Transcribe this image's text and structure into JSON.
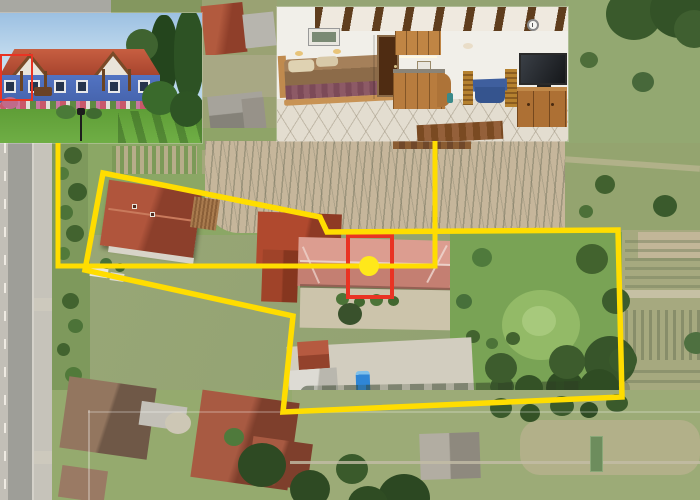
{
  "canvas": {
    "width": 700,
    "height": 500
  },
  "colors": {
    "annotation_yellow": "#FFDD00",
    "marker_yellow": "#FFE81A",
    "highlight_red": "#E93323"
  },
  "annotations": {
    "property_boundary": {
      "type": "polygon",
      "color": "#FFDD00",
      "stroke_width": 5.5,
      "points": [
        [
          103,
          173
        ],
        [
          320,
          217
        ],
        [
          327,
          232
        ],
        [
          618,
          230
        ],
        [
          622,
          397
        ],
        [
          283,
          412
        ],
        [
          293,
          316
        ],
        [
          85,
          270
        ]
      ]
    },
    "connectors": [
      {
        "color": "#FFDD00",
        "stroke_width": 5,
        "points": [
          [
            58,
            143
          ],
          [
            58,
            266
          ],
          [
            369,
            266
          ]
        ]
      },
      {
        "color": "#FFDD00",
        "stroke_width": 5,
        "points": [
          [
            435,
            141
          ],
          [
            435,
            266
          ],
          [
            369,
            266
          ]
        ]
      }
    ],
    "highlight_rect_map": {
      "x": 348,
      "y": 236,
      "w": 44,
      "h": 61,
      "color": "#E93323",
      "stroke_width": 4
    },
    "highlight_rect_inset": {
      "x": 1,
      "y": 55,
      "w": 31,
      "h": 45,
      "color": "#E93323",
      "stroke_width": 2
    },
    "marker_dot": {
      "cx": 369,
      "cy": 266,
      "r": 10,
      "color": "#FFE81A"
    }
  },
  "insets": {
    "exterior_photo": {
      "x": 0,
      "y": 13,
      "width": 202,
      "height": 130
    },
    "interior_photo": {
      "x": 277,
      "y": 7,
      "width": 291,
      "height": 134
    }
  }
}
